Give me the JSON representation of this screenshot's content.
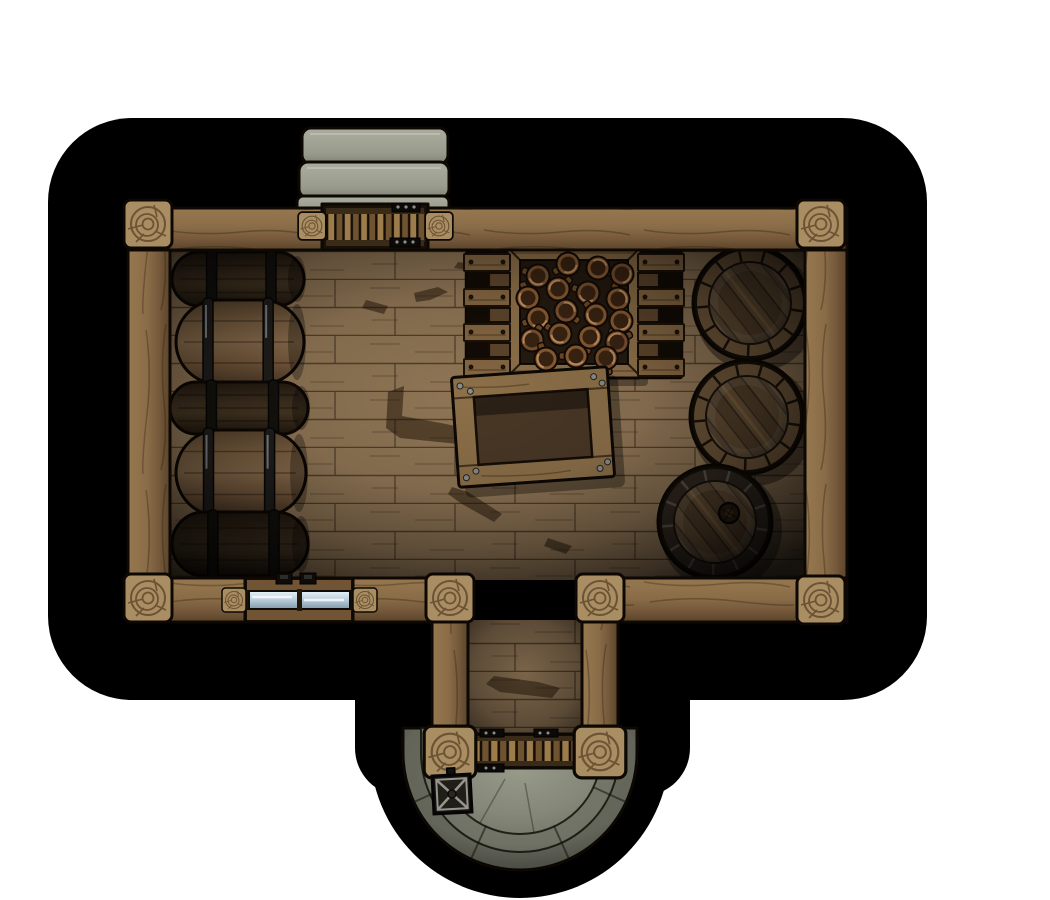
{
  "meta": {
    "asset_label": "Top-down storeroom battlemap with barrels, crates, stone steps and round porch",
    "canvas_w": 1050,
    "canvas_h": 900,
    "background": "#ffffff",
    "grid_visible": false
  },
  "palette": {
    "shadow": "#000000",
    "outline": "#0d0803",
    "beam_light": "#96784f",
    "beam_mid": "#82674a",
    "beam_dark": "#5a4429",
    "post": "#a98e63",
    "post_ring": "#6b5334",
    "floor_light": "#8f7555",
    "floor_mid": "#776043",
    "floor_dark": "#2e2213",
    "stone_light": "#a6a898",
    "stone_mid": "#8f9183",
    "stone_dark": "#6e7063",
    "barrel_side_light": "#8c6f4e",
    "barrel_side_dark": "#3f3020",
    "hoop": "#211f1c",
    "hoop_shine": "#c9cdd1",
    "barrel_rim": "#70573a",
    "stave_base": "#5e4830",
    "stave_alt": "#55412b",
    "crate_frame": "#8d7049",
    "crate_interior": "#241a10",
    "mug_body": "#8a5c33",
    "mug_dark": "#3a2412",
    "mug_highlight": "#c08a50",
    "glass_high": "#e8f2f8",
    "glass_low": "#7f99a9",
    "metal": "#15130f",
    "metal_hi": "#97948e",
    "door_slat_a": "#9c7c4a",
    "door_slat_b": "#6f522f",
    "door_rail": "#3a2a18",
    "stain": "rgba(28,15,4,0.5)"
  },
  "scene": {
    "steps_top": {
      "label": "stone steps at north entrance",
      "count": 3
    },
    "porch": {
      "label": "round stone porch with curved steps",
      "cx": 520,
      "cy": 753,
      "r_outer": 117,
      "r_mid": 99,
      "r_inner": 81
    },
    "top_door": {
      "label": "slatted entry door (north)"
    },
    "bottom_door": {
      "label": "slatted entry door (south porch)"
    },
    "window": {
      "label": "shuttered window with glass panes"
    },
    "lantern": {
      "label": "iron lantern",
      "cx": 452,
      "cy": 794
    },
    "side_barrel_stack": {
      "label": "stack of barrels lying on their sides",
      "rows": [
        {
          "x": 172,
          "y": 252,
          "w": 132,
          "h": 54,
          "tone": "dark"
        },
        {
          "x": 176,
          "y": 300,
          "w": 128,
          "h": 84,
          "tone": "light"
        },
        {
          "x": 170,
          "y": 382,
          "w": 138,
          "h": 52,
          "tone": "dark"
        },
        {
          "x": 176,
          "y": 430,
          "w": 130,
          "h": 86,
          "tone": "light"
        },
        {
          "x": 172,
          "y": 512,
          "w": 136,
          "h": 64,
          "tone": "dark"
        }
      ]
    },
    "mug_crate": {
      "label": "crate filled with mugs",
      "x": 506,
      "y": 246,
      "w": 136,
      "h": 132,
      "frame": 14,
      "mugs": [
        {
          "x": 538,
          "y": 276,
          "a": 200
        },
        {
          "x": 568,
          "y": 264,
          "a": 150
        },
        {
          "x": 598,
          "y": 268,
          "a": 20
        },
        {
          "x": 622,
          "y": 274,
          "a": 120
        },
        {
          "x": 528,
          "y": 298,
          "a": 250
        },
        {
          "x": 558,
          "y": 289,
          "a": 320
        },
        {
          "x": 588,
          "y": 293,
          "a": 200
        },
        {
          "x": 618,
          "y": 299,
          "a": 60
        },
        {
          "x": 538,
          "y": 318,
          "a": 160
        },
        {
          "x": 566,
          "y": 311,
          "a": 40
        },
        {
          "x": 596,
          "y": 315,
          "a": 230
        },
        {
          "x": 621,
          "y": 321,
          "a": 130
        },
        {
          "x": 532,
          "y": 340,
          "a": 300
        },
        {
          "x": 560,
          "y": 334,
          "a": 210
        },
        {
          "x": 590,
          "y": 337,
          "a": 100
        },
        {
          "x": 617,
          "y": 342,
          "a": 330
        },
        {
          "x": 546,
          "y": 359,
          "a": 250
        },
        {
          "x": 576,
          "y": 356,
          "a": 180
        },
        {
          "x": 606,
          "y": 358,
          "a": 80
        }
      ]
    },
    "racks": {
      "label": "slatted racks beside the mug crate",
      "items": [
        {
          "side": "left",
          "x": 468,
          "y": 254,
          "w": 38,
          "h": 122
        },
        {
          "side": "right",
          "x": 642,
          "y": 254,
          "w": 38,
          "h": 122
        }
      ]
    },
    "open_crate": {
      "label": "empty open crate",
      "cx": 533,
      "cy": 427,
      "rotation": -4
    },
    "round_barrels": {
      "label": "upright barrels seen from above",
      "items": [
        {
          "cx": 750,
          "cy": 303,
          "r": 57,
          "bung": false
        },
        {
          "cx": 747,
          "cy": 417,
          "r": 57,
          "bung": false
        },
        {
          "cx": 715,
          "cy": 522,
          "r": 57,
          "bung": true,
          "bung_cx": 729,
          "bung_cy": 513,
          "bung_r": 10
        }
      ]
    },
    "floor_stains": {
      "label": "scuffs and stains on floorboards",
      "items": [
        {
          "pts": "388,392 404,386 402,416 446,424 472,430 458,444 400,438 386,428"
        },
        {
          "pts": "414,293 438,287 448,292 430,300 416,302"
        },
        {
          "pts": "452,487 468,492 502,514 494,522 462,504 448,494"
        },
        {
          "pts": "548,538 572,546 566,554 544,546"
        },
        {
          "pts": "366,300 388,306 384,314 362,308"
        },
        {
          "pts": "494,676 538,682 560,688 552,698 500,692 486,684"
        },
        {
          "pts": "458,262 500,268 496,274 454,268"
        }
      ]
    }
  }
}
